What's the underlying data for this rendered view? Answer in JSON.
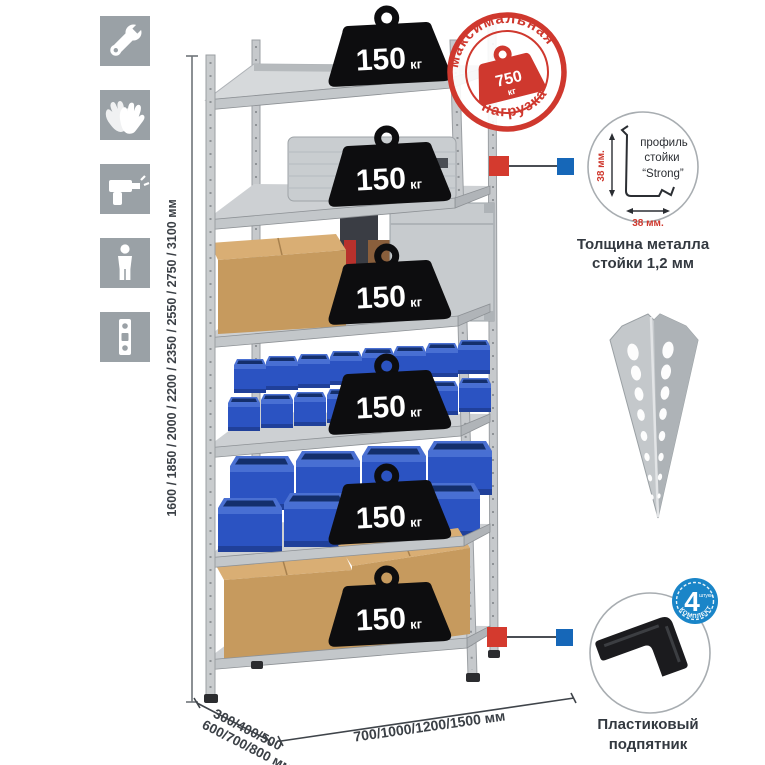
{
  "sidebar": {
    "icons": [
      "wrench",
      "gloves",
      "drill",
      "person",
      "level"
    ]
  },
  "dims": {
    "height_label": "1600 / 1850 / 2000 / 2200 / 2350 / 2550 / 2750 / 3100 мм",
    "depth_label_line1": "300/400/500",
    "depth_label_line2": "600/700/800 мм",
    "width_label": "700/1000/1200/1500 мм"
  },
  "stamp": {
    "arc_top": "максимальная",
    "arc_bottom": "нагрузка",
    "weight_value": "750",
    "weight_unit": "кг"
  },
  "shelf_load": {
    "value": "150",
    "unit": "кг",
    "shelves_count": 6
  },
  "profile_detail": {
    "label_line1": "профиль",
    "label_line2": "стойки",
    "label_line3": "“Strong”",
    "dim_vertical": "38 мм.",
    "dim_horizontal": "38 мм.",
    "caption_line1": "Толщина металла",
    "caption_line2": "стойки 1,2 мм"
  },
  "foot_detail": {
    "badge_value": "4",
    "badge_unit": "штуки",
    "badge_arc": "в комплекте",
    "caption_line1": "Пластиковый",
    "caption_line2": "подпятник"
  },
  "colors": {
    "accent_red": "#d43a2e",
    "accent_blue": "#1667b8",
    "stamp_red": "#cf382e",
    "badge_blue": "#1a85c8",
    "bin_blue": "#2b53c2",
    "metal_gray": "#c6c9cc",
    "tile_gray": "#9aa1a6",
    "cardboard": "#c69a5e",
    "text_dark": "#3b4046"
  }
}
